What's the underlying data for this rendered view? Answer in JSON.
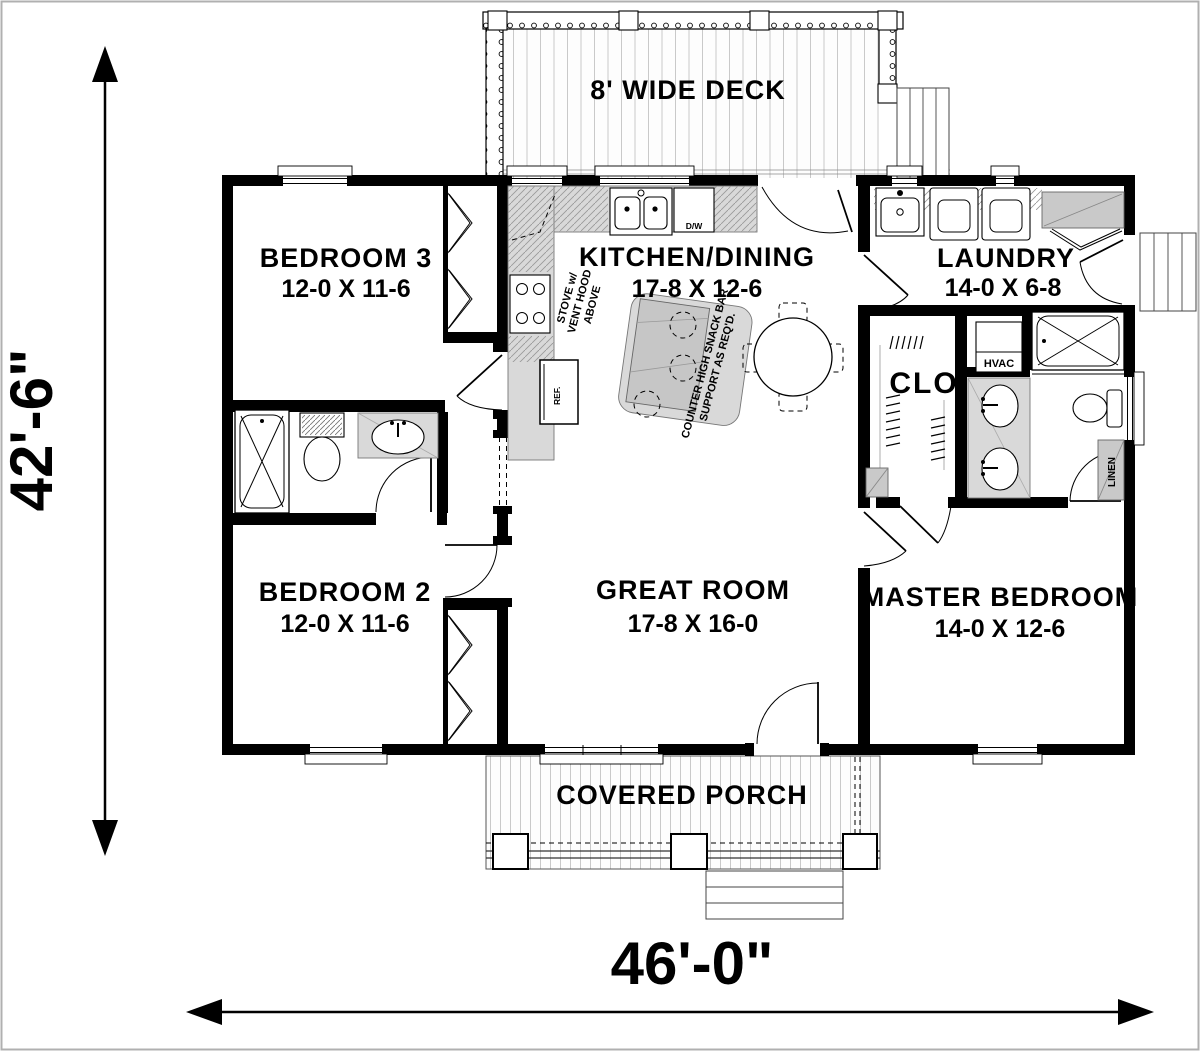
{
  "page": {
    "border_color": "#b0b0b0",
    "background": "#ffffff"
  },
  "dimensions": {
    "left": "42'-6\"",
    "bottom": "46'-0\""
  },
  "outdoor": {
    "deck_label": "8' WIDE DECK",
    "porch_label": "COVERED PORCH"
  },
  "rooms": {
    "bedroom3": {
      "name": "BEDROOM 3",
      "size": "12-0 X 11-6"
    },
    "bedroom2": {
      "name": "BEDROOM 2",
      "size": "12-0 X 11-6"
    },
    "kitchen_dining": {
      "name": "KITCHEN/DINING",
      "size": "17-8 X 12-6"
    },
    "laundry": {
      "name": "LAUNDRY",
      "size": "14-0 X 6-8"
    },
    "great_room": {
      "name": "GREAT ROOM",
      "size": "17-8 X 16-0"
    },
    "master_bedroom": {
      "name": "MASTER BEDROOM",
      "size": "14-0 X 12-6"
    },
    "closet": {
      "name": "CLO"
    }
  },
  "annotations": {
    "stove_line1": "STOVE w/",
    "stove_line2": "VENT HOOD",
    "stove_line3": "ABOVE",
    "snack_line1": "COUNTER HIGH SNACK BAR",
    "snack_line2": "SUPPORT AS REQ'D.",
    "ref": "REF.",
    "dw": "D/W",
    "hvac": "HVAC",
    "linen": "LINEN"
  },
  "colors": {
    "wall": "#000000",
    "counter": "#d9d9d9",
    "appliance_gray": "#cccccc",
    "plank_line": "#c9c9c9",
    "hatch": "#999999"
  }
}
